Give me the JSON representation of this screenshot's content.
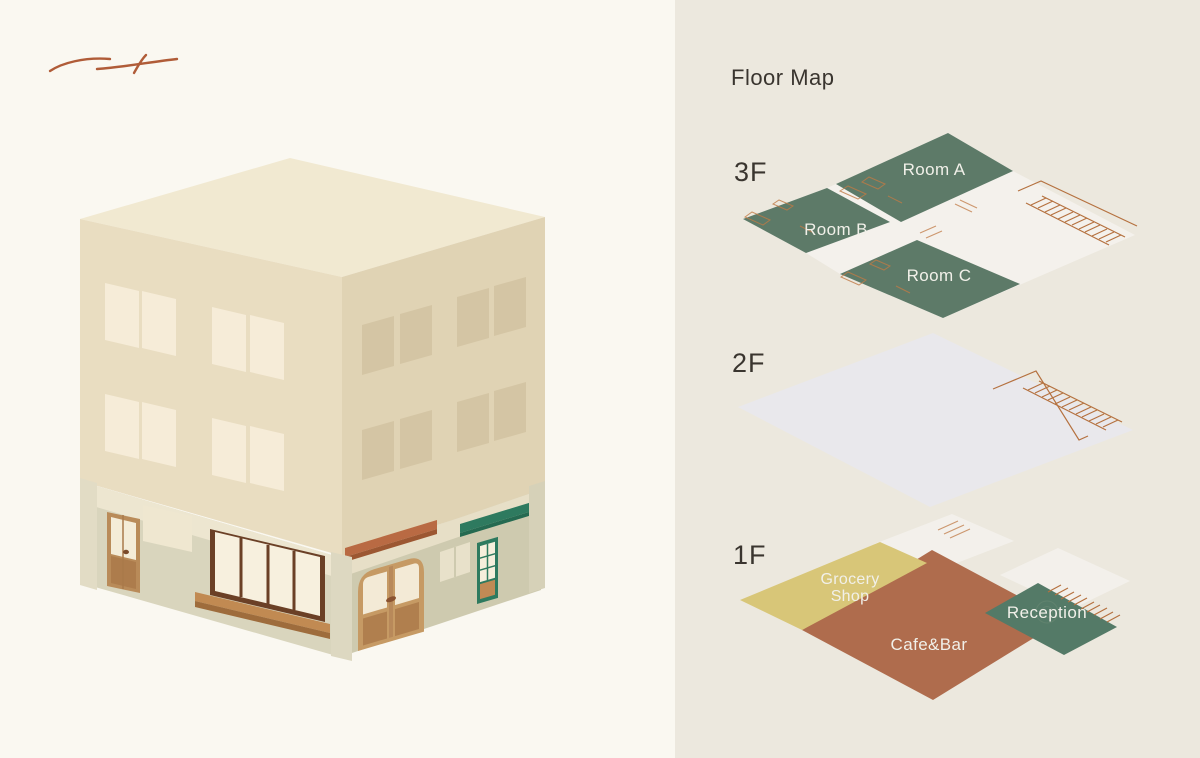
{
  "floor_map": {
    "title": "Floor Map",
    "floors": [
      {
        "label": "3F",
        "rooms": [
          {
            "name": "Room A"
          },
          {
            "name": "Room B"
          },
          {
            "name": "Room C"
          }
        ],
        "features": [
          "staircase"
        ]
      },
      {
        "label": "2F",
        "rooms": [],
        "features": [
          "staircase"
        ]
      },
      {
        "label": "1F",
        "rooms": [
          {
            "name": "Grocery Shop",
            "lines": [
              "Grocery",
              "Shop"
            ]
          },
          {
            "name": "Cafe&Bar"
          },
          {
            "name": "Reception"
          }
        ],
        "features": [
          "staircase"
        ]
      }
    ]
  },
  "left_panel": {
    "illustration": "isometric three-story building",
    "decoration": "brush-stroke"
  },
  "colors": {
    "background_left": "#faf8f1",
    "background_right": "#ece8de",
    "room_green": "#5d7a68",
    "reception_green": "#547a67",
    "grocery_yellow": "#d8c678",
    "cafe_rust": "#af6c4d",
    "plan_detail_orange": "#b5713f",
    "awning_rust": "#b96a43",
    "awning_teal": "#2e7a5f",
    "building_cream": "#e9ddc1",
    "title_text": "#3a352f",
    "label_text": "#f1f0e9"
  }
}
